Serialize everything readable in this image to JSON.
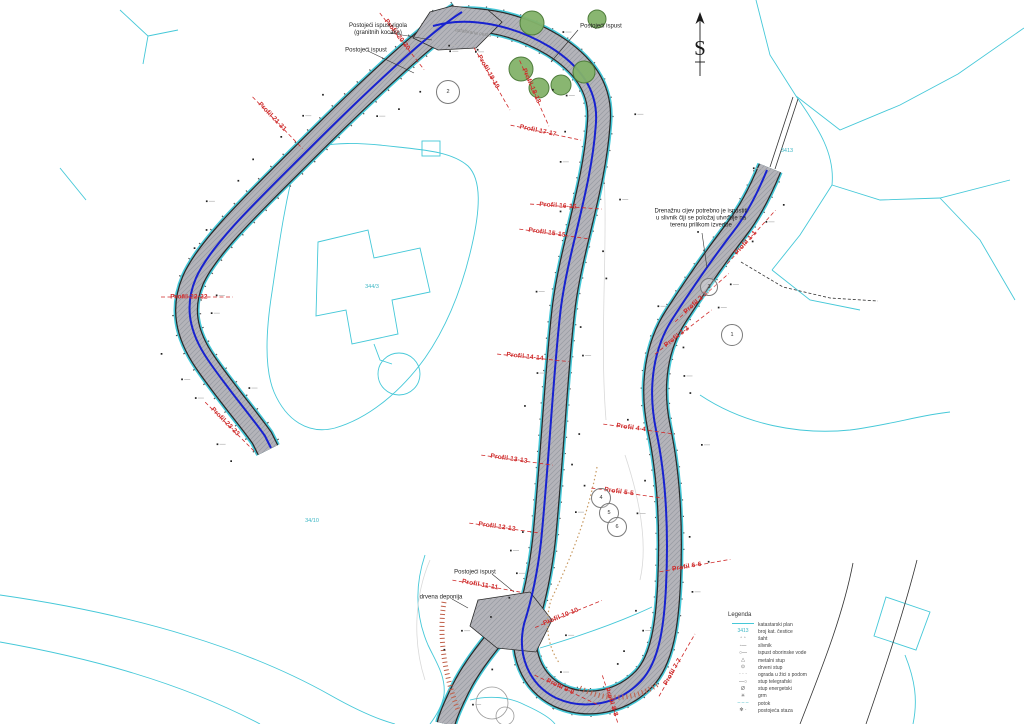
{
  "map": {
    "north": {
      "letter": "S"
    },
    "road_surface_label": "asfaltirana cesta",
    "notes": [
      {
        "text": "Postojeći ispust rigola\n(granitnih kocaka)",
        "x": 378,
        "y": 30
      },
      {
        "text": "Postojeći ispust",
        "x": 366,
        "y": 51
      },
      {
        "text": "Postojeći ispust",
        "x": 601,
        "y": 27
      },
      {
        "text": "Postojeći ispust",
        "x": 475,
        "y": 573
      },
      {
        "text": "drvena deponija",
        "x": 441,
        "y": 598
      },
      {
        "text": "Drenažnu cijev potrebno je ispustiti\nu slivnik čiji se položaj utvrđuje na\nterenu prilikom izvedbe",
        "x": 701,
        "y": 219
      }
    ],
    "profiles": [
      {
        "text": "Profil 1-1",
        "x": 746,
        "y": 243,
        "rot": -48
      },
      {
        "text": "Profil 2-2",
        "x": 696,
        "y": 303,
        "rot": -42
      },
      {
        "text": "Profil 3-3",
        "x": 677,
        "y": 337,
        "rot": -38
      },
      {
        "text": "Profil 4-4",
        "x": 631,
        "y": 428,
        "rot": 8
      },
      {
        "text": "Profil 5-5",
        "x": 619,
        "y": 492,
        "rot": 8
      },
      {
        "text": "Profil 6-6",
        "x": 687,
        "y": 567,
        "rot": -10
      },
      {
        "text": "Profil 7-7",
        "x": 673,
        "y": 672,
        "rot": -60
      },
      {
        "text": "Profil 8-8",
        "x": 611,
        "y": 702,
        "rot": 72
      },
      {
        "text": "Profil 9-9",
        "x": 560,
        "y": 687,
        "rot": 25
      },
      {
        "text": "Profil 10-10",
        "x": 561,
        "y": 617,
        "rot": -22
      },
      {
        "text": "Profil 11-11",
        "x": 480,
        "y": 585,
        "rot": 10
      },
      {
        "text": "Profil 12-12",
        "x": 497,
        "y": 527,
        "rot": 8
      },
      {
        "text": "Profil 13-13",
        "x": 509,
        "y": 459,
        "rot": 8
      },
      {
        "text": "Profil 14-14",
        "x": 525,
        "y": 357,
        "rot": 6
      },
      {
        "text": "Profil 15-15",
        "x": 547,
        "y": 233,
        "rot": 8
      },
      {
        "text": "Profil 16-16",
        "x": 558,
        "y": 206,
        "rot": 4
      },
      {
        "text": "Profil 17-17",
        "x": 538,
        "y": 131,
        "rot": 12
      },
      {
        "text": "Profil 18-18",
        "x": 531,
        "y": 86,
        "rot": 66
      },
      {
        "text": "Profil 19-19",
        "x": 488,
        "y": 72,
        "rot": 60
      },
      {
        "text": "Profil 20-20",
        "x": 397,
        "y": 35,
        "rot": 52
      },
      {
        "text": "Profil 21-21",
        "x": 272,
        "y": 117,
        "rot": 46
      },
      {
        "text": "Profil 22-22",
        "x": 189,
        "y": 297,
        "rot": 0
      },
      {
        "text": "Profil 23-23",
        "x": 225,
        "y": 422,
        "rot": 45
      }
    ],
    "parcel_numbers": [
      {
        "text": "344/3",
        "x": 372,
        "y": 287
      },
      {
        "text": "3413",
        "x": 787,
        "y": 151
      },
      {
        "text": "34/10",
        "x": 312,
        "y": 521
      }
    ],
    "callouts": [
      {
        "num": "2",
        "x": 447,
        "y": 91,
        "r": 11
      },
      {
        "num": "3",
        "x": 708,
        "y": 286,
        "r": 8
      },
      {
        "num": "1",
        "x": 731,
        "y": 334,
        "r": 10
      },
      {
        "num": "4",
        "x": 600,
        "y": 497,
        "r": 9
      },
      {
        "num": "5",
        "x": 608,
        "y": 512,
        "r": 9
      },
      {
        "num": "6",
        "x": 616,
        "y": 526,
        "r": 9
      }
    ],
    "colors": {
      "road_hatch": "#b3b3b8",
      "centerline_blue": "#1822cf",
      "cadastral_cyan": "#45c8d8",
      "profile_red": "#cf2b2b",
      "tree_green": "#83b269"
    }
  },
  "legend": {
    "title": "Legenda",
    "items": [
      {
        "symbol": "cyan-line",
        "label": "katastarski plan"
      },
      {
        "symbol": "cyan-number",
        "sample": "3413",
        "label": "broj kat. čestice"
      },
      {
        "symbol": "squares",
        "label": "šaht"
      },
      {
        "symbol": "slivnik",
        "label": "slivnik"
      },
      {
        "symbol": "ispust",
        "label": "ispust oborinske vode"
      },
      {
        "symbol": "triangle",
        "label": "metalni stup"
      },
      {
        "symbol": "circle-dot",
        "label": "drveni stup"
      },
      {
        "symbol": "fence",
        "label": "ograda u žici s podom"
      },
      {
        "symbol": "pole-t",
        "label": "stup telegrafski"
      },
      {
        "symbol": "pole-e",
        "label": "stup energetski"
      },
      {
        "symbol": "grm",
        "label": "grm"
      },
      {
        "symbol": "potok",
        "label": "potok"
      },
      {
        "symbol": "stone",
        "label": "postojeća staza"
      }
    ]
  }
}
